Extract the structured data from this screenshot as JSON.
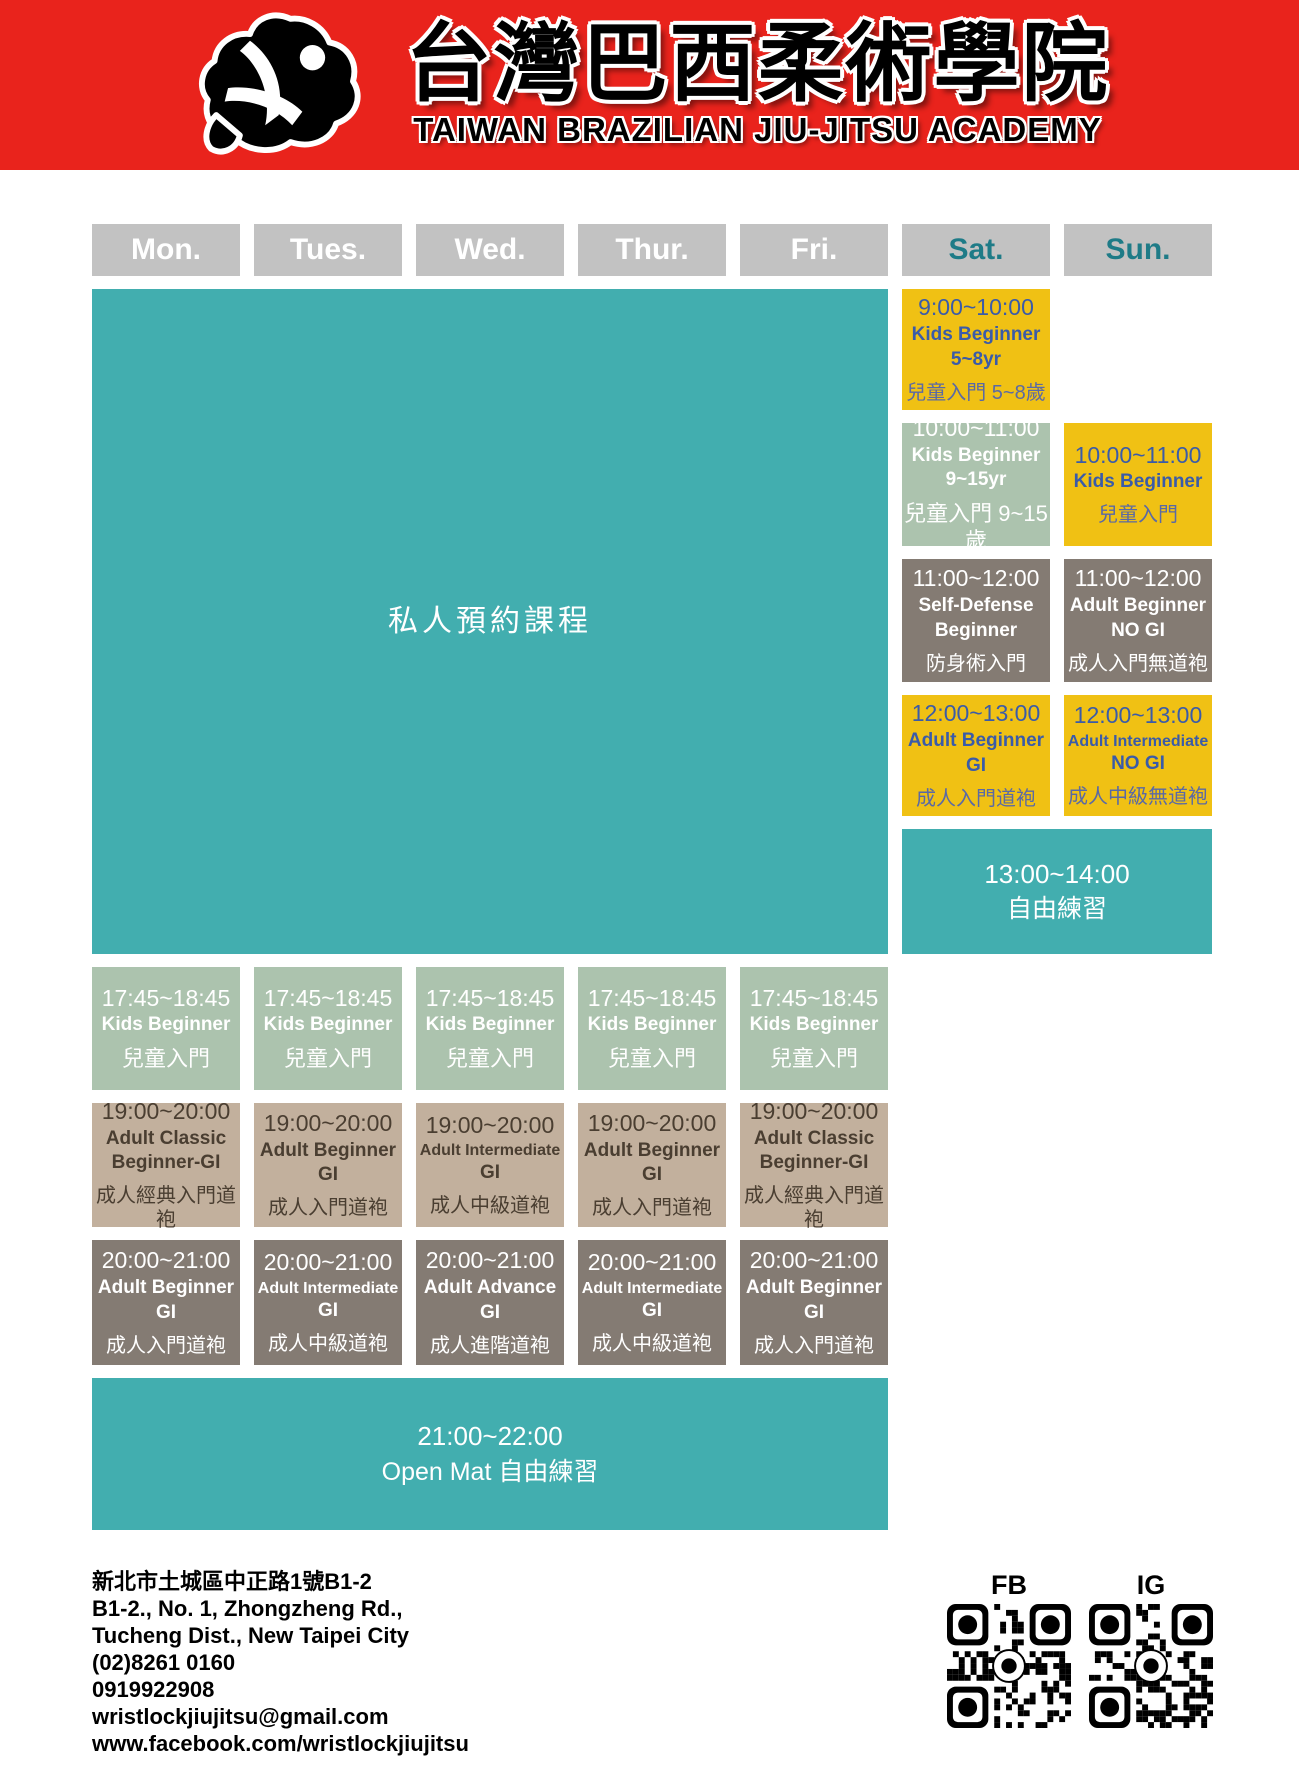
{
  "header": {
    "title_zh": "台灣巴西柔術學院",
    "subtitle_en": "TAIWAN BRAZILIAN JIU-JITSU ACADEMY",
    "logo": "grappler-silhouette-icon"
  },
  "days": [
    {
      "label": "Mon.",
      "weekend": false
    },
    {
      "label": "Tues.",
      "weekend": false
    },
    {
      "label": "Wed.",
      "weekend": false
    },
    {
      "label": "Thur.",
      "weekend": false
    },
    {
      "label": "Fri.",
      "weekend": false
    },
    {
      "label": "Sat.",
      "weekend": true
    },
    {
      "label": "Sun.",
      "weekend": true
    }
  ],
  "blocks": [
    {
      "name": "private-lessons-weekday",
      "col": 1,
      "colspan": 5,
      "row": 2,
      "rowspan": 5,
      "variant": "teal",
      "big": "私人預約課程"
    },
    {
      "name": "sat-kids-beginner-0900",
      "col": 6,
      "row": 2,
      "variant": "yellow",
      "time": "9:00~10:00",
      "lines": [
        "Kids Beginner",
        "5~8yr"
      ],
      "zh": "兒童入門 5~8歲"
    },
    {
      "name": "sat-kids-beginner-1000",
      "col": 6,
      "row": 3,
      "variant": "sage",
      "time": "10:00~11:00",
      "lines": [
        "Kids Beginner",
        "9~15yr"
      ],
      "zh": "兒童入門 9~15歲"
    },
    {
      "name": "sun-kids-beginner-1000",
      "col": 7,
      "row": 3,
      "variant": "yellow",
      "time": "10:00~11:00",
      "lines": [
        "Kids Beginner"
      ],
      "zh": "兒童入門"
    },
    {
      "name": "sat-self-defense-beginner-1100",
      "col": 6,
      "row": 4,
      "variant": "taupe",
      "time": "11:00~12:00",
      "lines": [
        "Self-Defense",
        "Beginner"
      ],
      "zh": "防身術入門"
    },
    {
      "name": "sun-adult-beginner-nogi-1100",
      "col": 7,
      "row": 4,
      "variant": "taupe",
      "time": "11:00~12:00",
      "lines": [
        "Adult Beginner",
        "NO GI"
      ],
      "zh": "成人入門無道袍"
    },
    {
      "name": "sat-adult-beginner-gi-1200",
      "col": 6,
      "row": 5,
      "variant": "yellow",
      "time": "12:00~13:00",
      "lines": [
        "Adult Beginner",
        "GI"
      ],
      "zh": "成人入門道袍"
    },
    {
      "name": "sun-adult-intermediate-nogi-1200",
      "col": 7,
      "row": 5,
      "variant": "yellow",
      "time": "12:00~13:00",
      "lines": [
        "Adult Intermediate",
        "NO GI"
      ],
      "zh": "成人中級無道袍"
    },
    {
      "name": "weekend-free-practice-1300",
      "col": 6,
      "colspan": 2,
      "row": 6,
      "variant": "teal",
      "time": "13:00~14:00",
      "zh": "自由練習"
    },
    {
      "name": "mon-kids-beginner-1745",
      "col": 1,
      "row": 7,
      "variant": "sage",
      "time": "17:45~18:45",
      "lines": [
        "Kids Beginner"
      ],
      "zh": "兒童入門"
    },
    {
      "name": "tue-kids-beginner-1745",
      "col": 2,
      "row": 7,
      "variant": "sage",
      "time": "17:45~18:45",
      "lines": [
        "Kids Beginner"
      ],
      "zh": "兒童入門"
    },
    {
      "name": "wed-kids-beginner-1745",
      "col": 3,
      "row": 7,
      "variant": "sage",
      "time": "17:45~18:45",
      "lines": [
        "Kids Beginner"
      ],
      "zh": "兒童入門"
    },
    {
      "name": "thu-kids-beginner-1745",
      "col": 4,
      "row": 7,
      "variant": "sage",
      "time": "17:45~18:45",
      "lines": [
        "Kids Beginner"
      ],
      "zh": "兒童入門"
    },
    {
      "name": "fri-kids-beginner-1745",
      "col": 5,
      "row": 7,
      "variant": "sage",
      "time": "17:45~18:45",
      "lines": [
        "Kids Beginner"
      ],
      "zh": "兒童入門"
    },
    {
      "name": "mon-adult-classic-beginner-gi-1900",
      "col": 1,
      "row": 8,
      "variant": "tan",
      "time": "19:00~20:00",
      "lines": [
        "Adult Classic",
        "Beginner-GI"
      ],
      "zh": "成人經典入門道袍"
    },
    {
      "name": "tue-adult-beginner-gi-1900",
      "col": 2,
      "row": 8,
      "variant": "tan",
      "time": "19:00~20:00",
      "lines": [
        "Adult Beginner",
        "GI"
      ],
      "zh": "成人入門道袍"
    },
    {
      "name": "wed-adult-intermediate-gi-1900",
      "col": 3,
      "row": 8,
      "variant": "tan",
      "time": "19:00~20:00",
      "lines": [
        "Adult Intermediate",
        "GI"
      ],
      "zh": "成人中級道袍"
    },
    {
      "name": "thu-adult-beginner-gi-1900",
      "col": 4,
      "row": 8,
      "variant": "tan",
      "time": "19:00~20:00",
      "lines": [
        "Adult Beginner",
        "GI"
      ],
      "zh": "成人入門道袍"
    },
    {
      "name": "fri-adult-classic-beginner-gi-1900",
      "col": 5,
      "row": 8,
      "variant": "tan",
      "time": "19:00~20:00",
      "lines": [
        "Adult Classic",
        "Beginner-GI"
      ],
      "zh": "成人經典入門道袍"
    },
    {
      "name": "mon-adult-beginner-gi-2000",
      "col": 1,
      "row": 9,
      "variant": "taupe",
      "time": "20:00~21:00",
      "lines": [
        "Adult Beginner",
        "GI"
      ],
      "zh": "成人入門道袍"
    },
    {
      "name": "tue-adult-intermediate-gi-2000",
      "col": 2,
      "row": 9,
      "variant": "taupe",
      "time": "20:00~21:00",
      "lines": [
        "Adult Intermediate",
        "GI"
      ],
      "zh": "成人中級道袍"
    },
    {
      "name": "wed-adult-advance-gi-2000",
      "col": 3,
      "row": 9,
      "variant": "taupe",
      "time": "20:00~21:00",
      "lines": [
        "Adult Advance",
        "GI"
      ],
      "zh": "成人進階道袍"
    },
    {
      "name": "thu-adult-intermediate-gi-2000",
      "col": 4,
      "row": 9,
      "variant": "taupe",
      "time": "20:00~21:00",
      "lines": [
        "Adult Intermediate",
        "GI"
      ],
      "zh": "成人中級道袍"
    },
    {
      "name": "fri-adult-beginner-gi-2000",
      "col": 5,
      "row": 9,
      "variant": "taupe",
      "time": "20:00~21:00",
      "lines": [
        "Adult Beginner",
        "GI"
      ],
      "zh": "成人入門道袍"
    },
    {
      "name": "weekday-open-mat-2100",
      "col": 1,
      "colspan": 5,
      "row": 10,
      "variant": "teal",
      "time": "21:00~22:00",
      "zh": "Open Mat 自由練習"
    }
  ],
  "footer": {
    "address_lines": [
      "新北市土城區中正路1號B1-2",
      "B1-2., No. 1, Zhongzheng Rd.,",
      "Tucheng Dist., New Taipei City",
      "(02)8261 0160",
      "0919922908",
      "wristlockjiujitsu@gmail.com",
      "www.facebook.com/wristlockjiujitsu"
    ],
    "qr_codes": [
      {
        "label": "FB"
      },
      {
        "label": "IG"
      }
    ]
  },
  "colors": {
    "red": "#E9231C",
    "teal": "#42AEAF",
    "yellow": "#F0C114",
    "sage": "#ACC3AE",
    "taupe": "#847B73",
    "tan": "#C2B09D",
    "header_gray": "#C2C2C2",
    "blue_text": "#3A5BA9",
    "brown_text": "#4A3E31",
    "weekend_label": "#1E7B87"
  }
}
